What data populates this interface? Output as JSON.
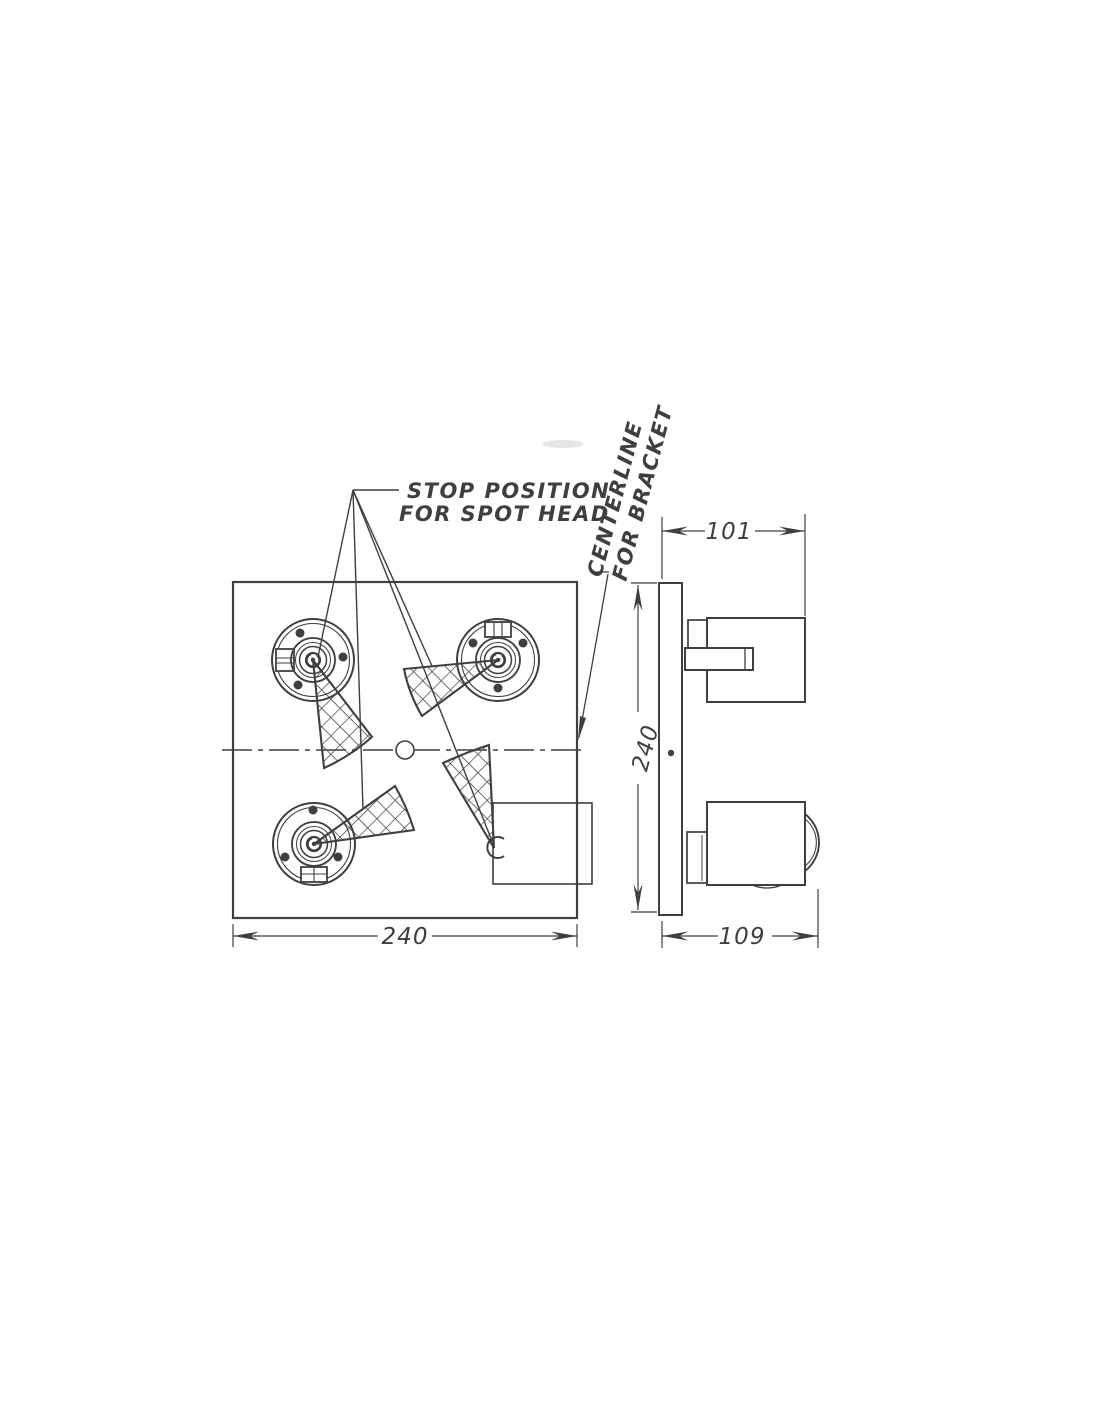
{
  "drawing": {
    "callouts": {
      "stop_position": {
        "line1": "STOP POSITION",
        "line2": "FOR SPOT HEAD"
      },
      "centerline": {
        "line1": "CENTERLINE",
        "line2": "FOR BRACKET"
      }
    },
    "dimensions": {
      "front_plate_width": "240",
      "side_plate_height": "240",
      "bracket_depth": "101",
      "overall_depth": "109"
    },
    "colors": {
      "ink": "#3f3f3f",
      "paper": "#ffffff"
    }
  }
}
